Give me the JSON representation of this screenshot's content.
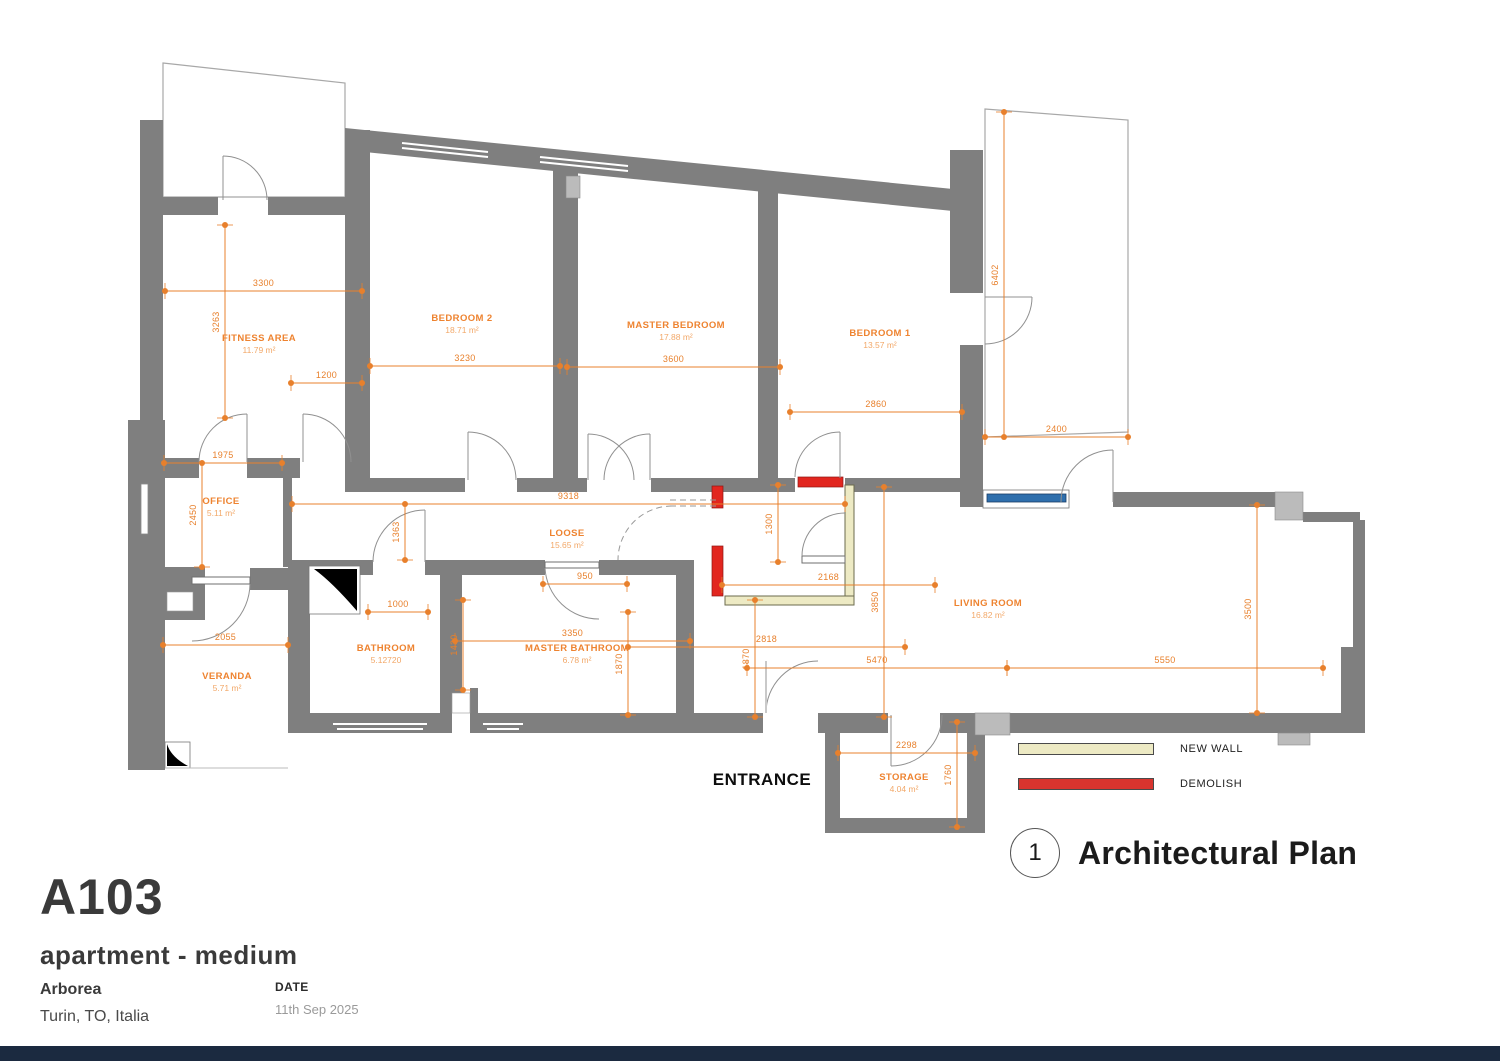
{
  "colors": {
    "wall": "#7F7F7F",
    "pillar": "#BBBBBB",
    "dim": "#E8802C",
    "room_name": "#EE8330",
    "room_area": "#F2A869",
    "new_wall": "#EDEAC4",
    "demolish": "#D8342E",
    "window_blue": "#2E6FAD",
    "footer": "#1B2A40"
  },
  "title_block": {
    "code": "A103",
    "subtitle": "apartment - medium",
    "project": "Arborea",
    "location": "Turin, TO, Italia",
    "date_label": "DATE",
    "date_value": "11th Sep 2025"
  },
  "plan_title": {
    "number": "1",
    "title": "Architectural Plan"
  },
  "legend": {
    "items": [
      {
        "label": "NEW WALL",
        "key": "new_wall"
      },
      {
        "label": "DEMOLISH",
        "key": "demolish"
      }
    ]
  },
  "entrance": "ENTRANCE",
  "rooms": [
    {
      "name": "FITNESS AREA",
      "area": "11.79 m²",
      "x": 259,
      "y": 333
    },
    {
      "name": "BEDROOM 2",
      "area": "18.71 m²",
      "x": 462,
      "y": 313
    },
    {
      "name": "MASTER BEDROOM",
      "area": "17.88 m²",
      "x": 676,
      "y": 320
    },
    {
      "name": "BEDROOM 1",
      "area": "13.57 m²",
      "x": 880,
      "y": 328
    },
    {
      "name": "OFFICE",
      "area": "5.11 m²",
      "x": 221,
      "y": 496
    },
    {
      "name": "LOOSE",
      "area": "15.65 m²",
      "x": 567,
      "y": 528
    },
    {
      "name": "BATHROOM",
      "area": "5.12720",
      "x": 386,
      "y": 643
    },
    {
      "name": "MASTER BATHROOM",
      "area": "6.78 m²",
      "x": 577,
      "y": 643
    },
    {
      "name": "VERANDA",
      "area": "5.71 m²",
      "x": 227,
      "y": 671
    },
    {
      "name": "LIVING ROOM",
      "area": "16.82 m²",
      "x": 988,
      "y": 598
    },
    {
      "name": "STORAGE",
      "area": "4.04 m²",
      "x": 904,
      "y": 772
    }
  ],
  "dimensions": [
    {
      "v": "3300",
      "x1": 165,
      "y1": 291,
      "x2": 362,
      "y2": 291
    },
    {
      "v": "1200",
      "x1": 291,
      "y1": 383,
      "x2": 362,
      "y2": 383
    },
    {
      "v": "3230",
      "x1": 370,
      "y1": 366,
      "x2": 560,
      "y2": 366
    },
    {
      "v": "3600",
      "x1": 567,
      "y1": 367,
      "x2": 780,
      "y2": 367
    },
    {
      "v": "2860",
      "x1": 790,
      "y1": 412,
      "x2": 962,
      "y2": 412
    },
    {
      "v": "2400",
      "x1": 985,
      "y1": 437,
      "x2": 1128,
      "y2": 437
    },
    {
      "v": "1975",
      "x1": 164,
      "y1": 463,
      "x2": 282,
      "y2": 463
    },
    {
      "v": "9318",
      "x1": 292,
      "y1": 504,
      "x2": 845,
      "y2": 504
    },
    {
      "v": "950",
      "x1": 543,
      "y1": 584,
      "x2": 627,
      "y2": 584
    },
    {
      "v": "1000",
      "x1": 368,
      "y1": 612,
      "x2": 428,
      "y2": 612
    },
    {
      "v": "2055",
      "x1": 163,
      "y1": 645,
      "x2": 288,
      "y2": 645
    },
    {
      "v": "3350",
      "x1": 455,
      "y1": 641,
      "x2": 690,
      "y2": 641
    },
    {
      "v": "2818",
      "x1": 628,
      "y1": 647,
      "x2": 905,
      "y2": 647
    },
    {
      "v": "2168",
      "x1": 722,
      "y1": 585,
      "x2": 935,
      "y2": 585
    },
    {
      "v": "5470",
      "x1": 747,
      "y1": 668,
      "x2": 1007,
      "y2": 668
    },
    {
      "v": "5550",
      "x1": 1007,
      "y1": 668,
      "x2": 1323,
      "y2": 668
    },
    {
      "v": "2298",
      "x1": 838,
      "y1": 753,
      "x2": 975,
      "y2": 753
    },
    {
      "v": "3263",
      "x1": 225,
      "y1": 225,
      "x2": 225,
      "y2": 418
    },
    {
      "v": "2450",
      "x1": 202,
      "y1": 463,
      "x2": 202,
      "y2": 567
    },
    {
      "v": "6402",
      "x1": 1004,
      "y1": 112,
      "x2": 1004,
      "y2": 437
    },
    {
      "v": "1363",
      "x1": 405,
      "y1": 504,
      "x2": 405,
      "y2": 560
    },
    {
      "v": "1430",
      "x1": 463,
      "y1": 600,
      "x2": 463,
      "y2": 690
    },
    {
      "v": "1870",
      "x1": 628,
      "y1": 612,
      "x2": 628,
      "y2": 715
    },
    {
      "v": "1870",
      "x1": 755,
      "y1": 600,
      "x2": 755,
      "y2": 717
    },
    {
      "v": "1300",
      "x1": 778,
      "y1": 485,
      "x2": 778,
      "y2": 562
    },
    {
      "v": "3850",
      "x1": 884,
      "y1": 487,
      "x2": 884,
      "y2": 717
    },
    {
      "v": "3500",
      "x1": 1257,
      "y1": 505,
      "x2": 1257,
      "y2": 713
    },
    {
      "v": "1760",
      "x1": 957,
      "y1": 722,
      "x2": 957,
      "y2": 827
    }
  ]
}
